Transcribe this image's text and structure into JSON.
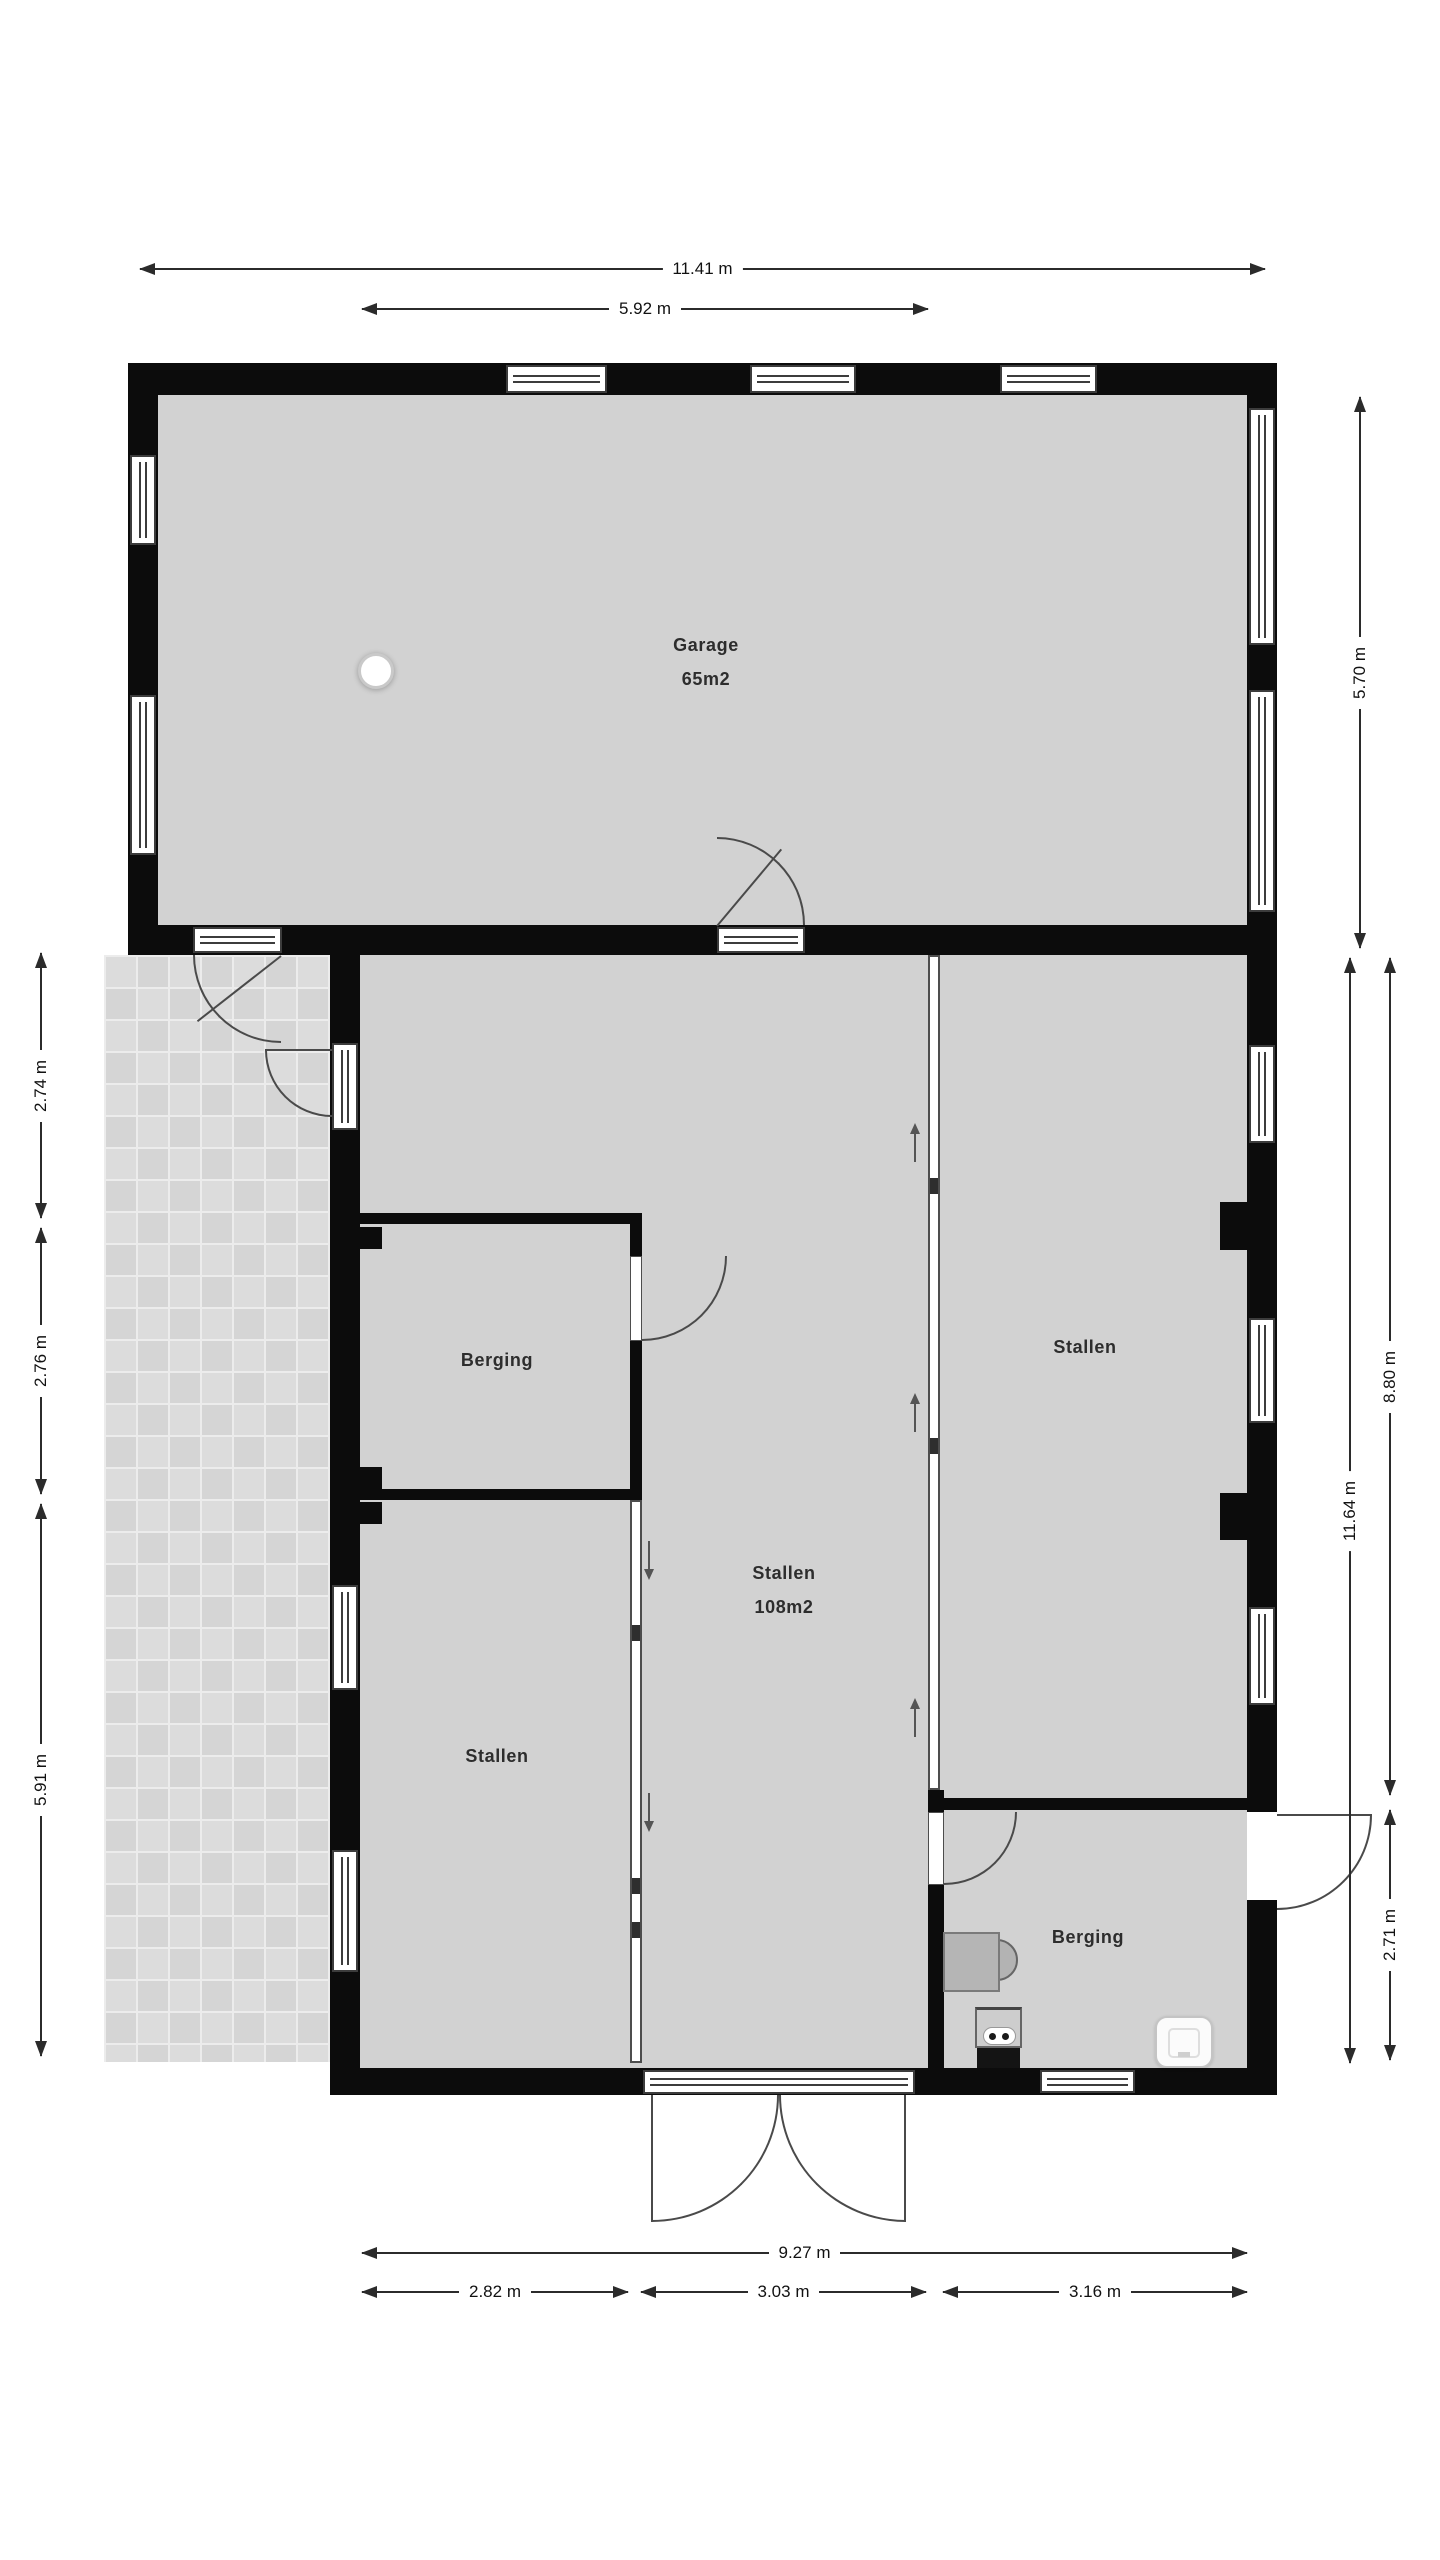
{
  "plan": {
    "rooms": {
      "garage": {
        "name": "Garage",
        "area": "65m2"
      },
      "stallen_center": {
        "name": "Stallen",
        "area": "108m2"
      },
      "stallen_right": {
        "name": "Stallen"
      },
      "stallen_left": {
        "name": "Stallen"
      },
      "berging_upper": {
        "name": "Berging"
      },
      "berging_lower": {
        "name": "Berging"
      }
    },
    "dimensions": {
      "top_total": "11.41 m",
      "top_inner": "5.92 m",
      "right_garage": "5.70 m",
      "right_stallen": "8.80 m",
      "right_total": "11.64 m",
      "right_berging": "2.71 m",
      "left_top": "2.74 m",
      "left_middle": "2.76 m",
      "left_bottom": "5.91 m",
      "bottom_total": "9.27 m",
      "bottom_left": "2.82 m",
      "bottom_center": "3.03 m",
      "bottom_right": "3.16 m"
    },
    "icons": {
      "ceiling_light": "ceiling-light-icon",
      "toilet": "toilet-icon",
      "boiler": "boiler-icon",
      "outlet_panel": "outlet-panel-icon"
    },
    "colors": {
      "wall": "#0c0c0c",
      "floor": "#d2d2d2",
      "terrace": "#dcdcdc",
      "line": "#2b2b2b",
      "door": "#4a4a4a"
    }
  }
}
